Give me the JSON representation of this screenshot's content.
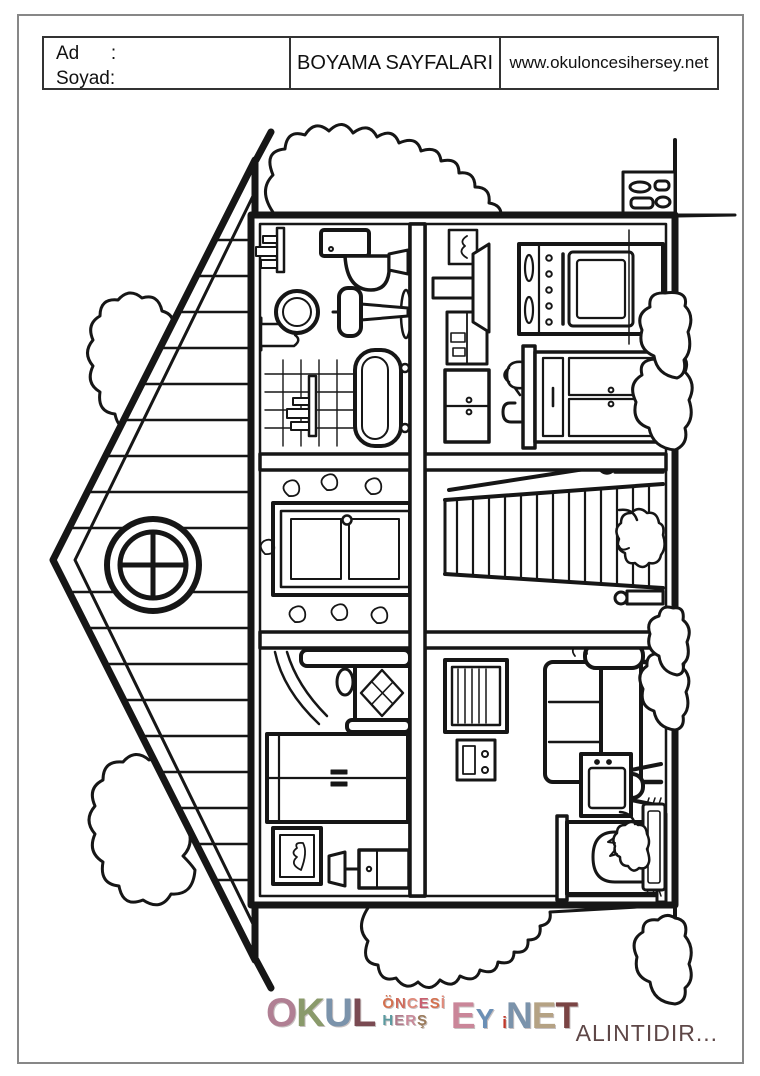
{
  "page": {
    "background": "#ffffff",
    "border_color": "#878787"
  },
  "header": {
    "name_line": "Ad      :",
    "surname_line": "Soyad:",
    "title": "BOYAMA SAYFALARI",
    "website": "www.okuloncesihersey.net"
  },
  "illustration": {
    "alt": "Sideways (rotated 90 degrees) black-and-white coloring drawing of a dollhouse cross-section: gable roof with round window, six rooms (bathroom, hallway and bedroom upstairs; kitchen, staircase and living room downstairs), with trees, clouds and bushes around the house.",
    "rooms": [
      "bathroom",
      "hallway",
      "bedroom",
      "kitchen",
      "staircase",
      "living-room"
    ]
  },
  "footer": {
    "logo": {
      "alt": "OKUL ÖNCESİ HERŞEY .NET",
      "letters": {
        "okul": [
          {
            "ch": "O",
            "c": "#b07f93"
          },
          {
            "ch": "K",
            "c": "#8a9a6b"
          },
          {
            "ch": "U",
            "c": "#7b93ab"
          },
          {
            "ch": "L",
            "c": "#7a4a52"
          }
        ],
        "oncesi": [
          {
            "ch": "Ö",
            "c": "#d4714f"
          },
          {
            "ch": "N",
            "c": "#cf6a5a"
          },
          {
            "ch": "C",
            "c": "#e08a7a"
          },
          {
            "ch": "E",
            "c": "#c85f6f"
          },
          {
            "ch": "S",
            "c": "#d4714f"
          },
          {
            "ch": "İ",
            "c": "#e08a7a"
          }
        ],
        "hersey": [
          {
            "ch": "H",
            "c": "#5b9aa0"
          },
          {
            "ch": "E",
            "c": "#b07a8a"
          },
          {
            "ch": "R",
            "c": "#c98a9a"
          },
          {
            "ch": "Ş",
            "c": "#9a7a5a"
          }
        ],
        "ey": [
          {
            "ch": "E",
            "c": "#ca8699",
            "sz": "big"
          },
          {
            "ch": "Y",
            "c": "#6b8fb5",
            "sz": "mid"
          }
        ],
        "net": [
          {
            "ch": "i",
            "c": "#c0392b",
            "sz": "xs"
          },
          {
            "ch": "N",
            "c": "#7b93ab"
          },
          {
            "ch": "E",
            "c": "#b5a284"
          },
          {
            "ch": "T",
            "c": "#7a4444"
          }
        ]
      }
    },
    "attribution": "ALINTIDIR..."
  }
}
